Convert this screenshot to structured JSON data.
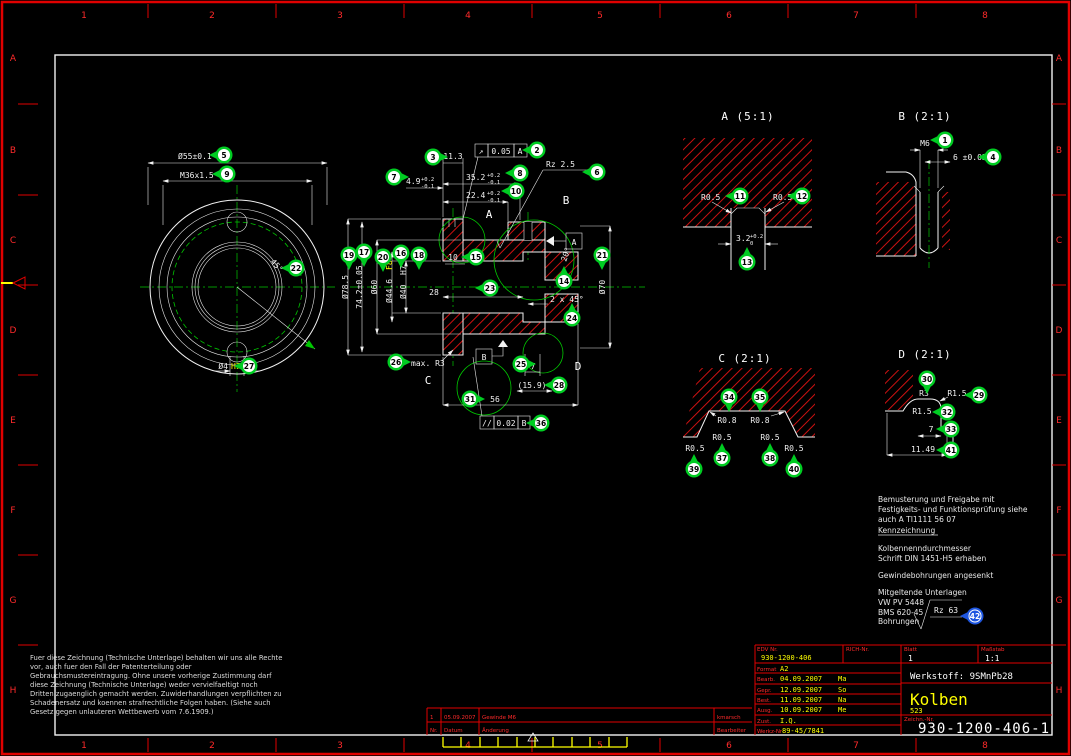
{
  "frame": {
    "top_numbers": [
      "1",
      "2",
      "3",
      "4",
      "5",
      "6",
      "7",
      "8"
    ],
    "side_letters": [
      "A",
      "B",
      "C",
      "D",
      "E",
      "F",
      "G",
      "H"
    ]
  },
  "front_view": {
    "dim_diameter": "Ø55±0.1",
    "dim_thread": "M36x1.5",
    "dim_angle": "45°",
    "dim_hole": "Ø4",
    "dim_hole_fit": "H7"
  },
  "section_view": {
    "dim_11_3": "11.3",
    "fcf_runout": {
      "sym": "↗",
      "tol": "0.05",
      "datum": "A"
    },
    "dim_4_9": {
      "val": "4.9",
      "up": "+0.2",
      "dn": "-0.1"
    },
    "dim_35_2": {
      "val": "35.2",
      "up": "+0.2",
      "dn": "-0.1"
    },
    "dim_22_4": {
      "val": "22.4",
      "up": "+0.2",
      "dn": "-0.1"
    },
    "rz": "Rz 2.5",
    "dia_stack": {
      "d1": "Ø78.5",
      "d2": "74.2±0.05",
      "d3": "Ø60",
      "d4": "Ø44.6",
      "d4_fit": "F8",
      "d5": "Ø40",
      "d5_fit": "H7"
    },
    "dim_10": "10",
    "dim_28": "28",
    "dim_20deg": "20°",
    "dim_70": "Ø70",
    "dim_chamfer": "2 x 45°",
    "dim_7": "7",
    "dim_15_9": "(15.9)",
    "dim_56": "56",
    "fcf_parallel": {
      "sym": "//",
      "tol": "0.02",
      "datum": "B"
    },
    "max_r3": "max. R3",
    "datum_a": "A",
    "datum_b": "B",
    "letter_a": "A",
    "letter_b": "B",
    "letter_c": "C",
    "letter_d": "D"
  },
  "detail_a": {
    "title": "A (5:1)",
    "r_left": "R0.5",
    "r_right": "R0.5",
    "width": {
      "val": "3.2",
      "up": "+0.2",
      "dn": "0"
    }
  },
  "detail_b": {
    "title": "B (2:1)",
    "thread": "M6",
    "depth": "6 ±0.05"
  },
  "detail_c": {
    "title": "C (2:1)",
    "r1": "R0.8",
    "r2": "R0.8",
    "r3": "R0.5",
    "r4": "R0.5",
    "r5": "R0.5",
    "r6": "R0.5"
  },
  "detail_d": {
    "title": "D (2:1)",
    "r3": "R3",
    "r15a": "R1.5",
    "r15b": "R1.5",
    "dim7": "7",
    "dim1149": "11.49"
  },
  "notes": {
    "l1": "Bemusterung und Freigabe mit",
    "l2": "Festigkeits- und Funktionsprüfung siehe",
    "l3": "auch A TI1111 56 07",
    "kennz": "Kennzeichnung",
    "l4": "Kolbennenndurchmesser",
    "l5": "Schrift DIN 1451-H5 erhaben",
    "l6": "Gewindebohrungen angesenkt",
    "l7": "Mitgeltende Unterlagen",
    "l8": "VW PV 5448",
    "l9": "BMS 620-45",
    "bohrungen": "Bohrungen",
    "rz": "Rz 63",
    "balloon": "42"
  },
  "legal": {
    "lines": [
      "Fuer diese Zeichnung (Technische Unterlage) behalten wir uns alle Rechte",
      "vor, auch fuer den Fall der Patenterteilung oder",
      "Gebrauchsmustereintragung. Ohne unsere vorherige Zustimmung darf",
      "diese Zeichnung (Technische Unterlage) weder vervielfaeltigt noch",
      "Dritten zugaenglich gemacht werden. Zuwiderhandlungen verpflichten zu",
      "Schadenersatz und koennen strafrechtliche Folgen haben. (Siehe auch",
      "Gesetz gegen unlauteren Wettbewerb vom 7.6.1909.)"
    ]
  },
  "revision": {
    "header": {
      "nr": "Nr.",
      "datum": "Datum",
      "aenderung": "Änderung",
      "bearbeiter": "Bearbeiter"
    },
    "row": {
      "nr": "1",
      "datum": "05.09.2007",
      "aenderung": "Gewinde M6",
      "bearbeiter": "kmarsch"
    }
  },
  "title_block": {
    "edv_label": "EDV Nr.",
    "edv_value": "930-1200-406",
    "rich_label": "RICH-Nr.",
    "blatt_label": "Blatt",
    "blatt_value": "1",
    "masstab_label": "Maßstab",
    "masstab_value": "1:1",
    "format_label": "Format",
    "format_value": "A2",
    "rows": [
      {
        "label": "Bearb.",
        "date": "04.09.2007",
        "sign": "Ma"
      },
      {
        "label": "Gepr.",
        "date": "12.09.2007",
        "sign": "So"
      },
      {
        "label": "Best.",
        "date": "11.09.2007",
        "sign": "Na"
      },
      {
        "label": "Ausg.",
        "date": "10.09.2007",
        "sign": "Me"
      }
    ],
    "zust_label": "Zust.",
    "zust_value": "I.Q.",
    "werkz_label": "Werkz-Nr",
    "werkz_value": "89-45/7841",
    "werkstoff": "Werkstoff: 9SMnPb28",
    "part_name": "Kolben",
    "part_sub": "523",
    "zeichn_label": "Zeichn.-Nr.",
    "zeichn_value": "930-1200-406-1"
  },
  "colors": {
    "balloon_green": "#00cc22",
    "balloon_blue": "#1e56e0",
    "hatch_red": "#cc1111",
    "frame_red": "#e00000",
    "line_white": "#f2f2f2",
    "value_yellow": "#ffff00",
    "centerline_green": "#00c800"
  },
  "balloons": [
    {
      "n": "1",
      "x": 945,
      "y": 140,
      "dir": "L"
    },
    {
      "n": "2",
      "x": 537,
      "y": 150,
      "dir": "L"
    },
    {
      "n": "3",
      "x": 433,
      "y": 157,
      "dir": "R"
    },
    {
      "n": "4",
      "x": 993,
      "y": 157,
      "dir": "L"
    },
    {
      "n": "5",
      "x": 224,
      "y": 155,
      "dir": "L"
    },
    {
      "n": "6",
      "x": 597,
      "y": 172,
      "dir": "L"
    },
    {
      "n": "7",
      "x": 394,
      "y": 177,
      "dir": "R"
    },
    {
      "n": "8",
      "x": 520,
      "y": 173,
      "dir": "L"
    },
    {
      "n": "9",
      "x": 227,
      "y": 174,
      "dir": "L"
    },
    {
      "n": "10",
      "x": 516,
      "y": 191,
      "dir": "L"
    },
    {
      "n": "11",
      "x": 740,
      "y": 196,
      "dir": "L"
    },
    {
      "n": "12",
      "x": 802,
      "y": 196,
      "dir": "L"
    },
    {
      "n": "13",
      "x": 747,
      "y": 262,
      "dir": "U"
    },
    {
      "n": "14",
      "x": 564,
      "y": 281,
      "dir": "U"
    },
    {
      "n": "15",
      "x": 476,
      "y": 257,
      "dir": "L"
    },
    {
      "n": "16",
      "x": 401,
      "y": 253,
      "dir": "D"
    },
    {
      "n": "17",
      "x": 364,
      "y": 252,
      "dir": "D"
    },
    {
      "n": "18",
      "x": 419,
      "y": 255,
      "dir": "D"
    },
    {
      "n": "19",
      "x": 349,
      "y": 255,
      "dir": "D"
    },
    {
      "n": "20",
      "x": 383,
      "y": 257,
      "dir": "D"
    },
    {
      "n": "21",
      "x": 602,
      "y": 255,
      "dir": "D"
    },
    {
      "n": "22",
      "x": 296,
      "y": 268,
      "dir": "L"
    },
    {
      "n": "23",
      "x": 490,
      "y": 288,
      "dir": "L"
    },
    {
      "n": "24",
      "x": 572,
      "y": 318,
      "dir": "U"
    },
    {
      "n": "25",
      "x": 521,
      "y": 364,
      "dir": "R"
    },
    {
      "n": "26",
      "x": 396,
      "y": 362,
      "dir": "R"
    },
    {
      "n": "27",
      "x": 249,
      "y": 366,
      "dir": "L"
    },
    {
      "n": "28",
      "x": 559,
      "y": 385,
      "dir": "L"
    },
    {
      "n": "29",
      "x": 979,
      "y": 395,
      "dir": "L"
    },
    {
      "n": "30",
      "x": 927,
      "y": 379,
      "dir": "D"
    },
    {
      "n": "31",
      "x": 470,
      "y": 399,
      "dir": "R"
    },
    {
      "n": "32",
      "x": 947,
      "y": 412,
      "dir": "L"
    },
    {
      "n": "33",
      "x": 951,
      "y": 429,
      "dir": "L"
    },
    {
      "n": "34",
      "x": 729,
      "y": 397,
      "dir": "D"
    },
    {
      "n": "35",
      "x": 760,
      "y": 397,
      "dir": "D"
    },
    {
      "n": "36",
      "x": 541,
      "y": 423,
      "dir": "L"
    },
    {
      "n": "37",
      "x": 722,
      "y": 458,
      "dir": "U"
    },
    {
      "n": "38",
      "x": 770,
      "y": 458,
      "dir": "U"
    },
    {
      "n": "39",
      "x": 694,
      "y": 469,
      "dir": "U"
    },
    {
      "n": "40",
      "x": 794,
      "y": 469,
      "dir": "U"
    },
    {
      "n": "41",
      "x": 951,
      "y": 450,
      "dir": "L"
    },
    {
      "n": "42",
      "x": 975,
      "y": 616,
      "dir": "L",
      "c": "blue"
    }
  ]
}
